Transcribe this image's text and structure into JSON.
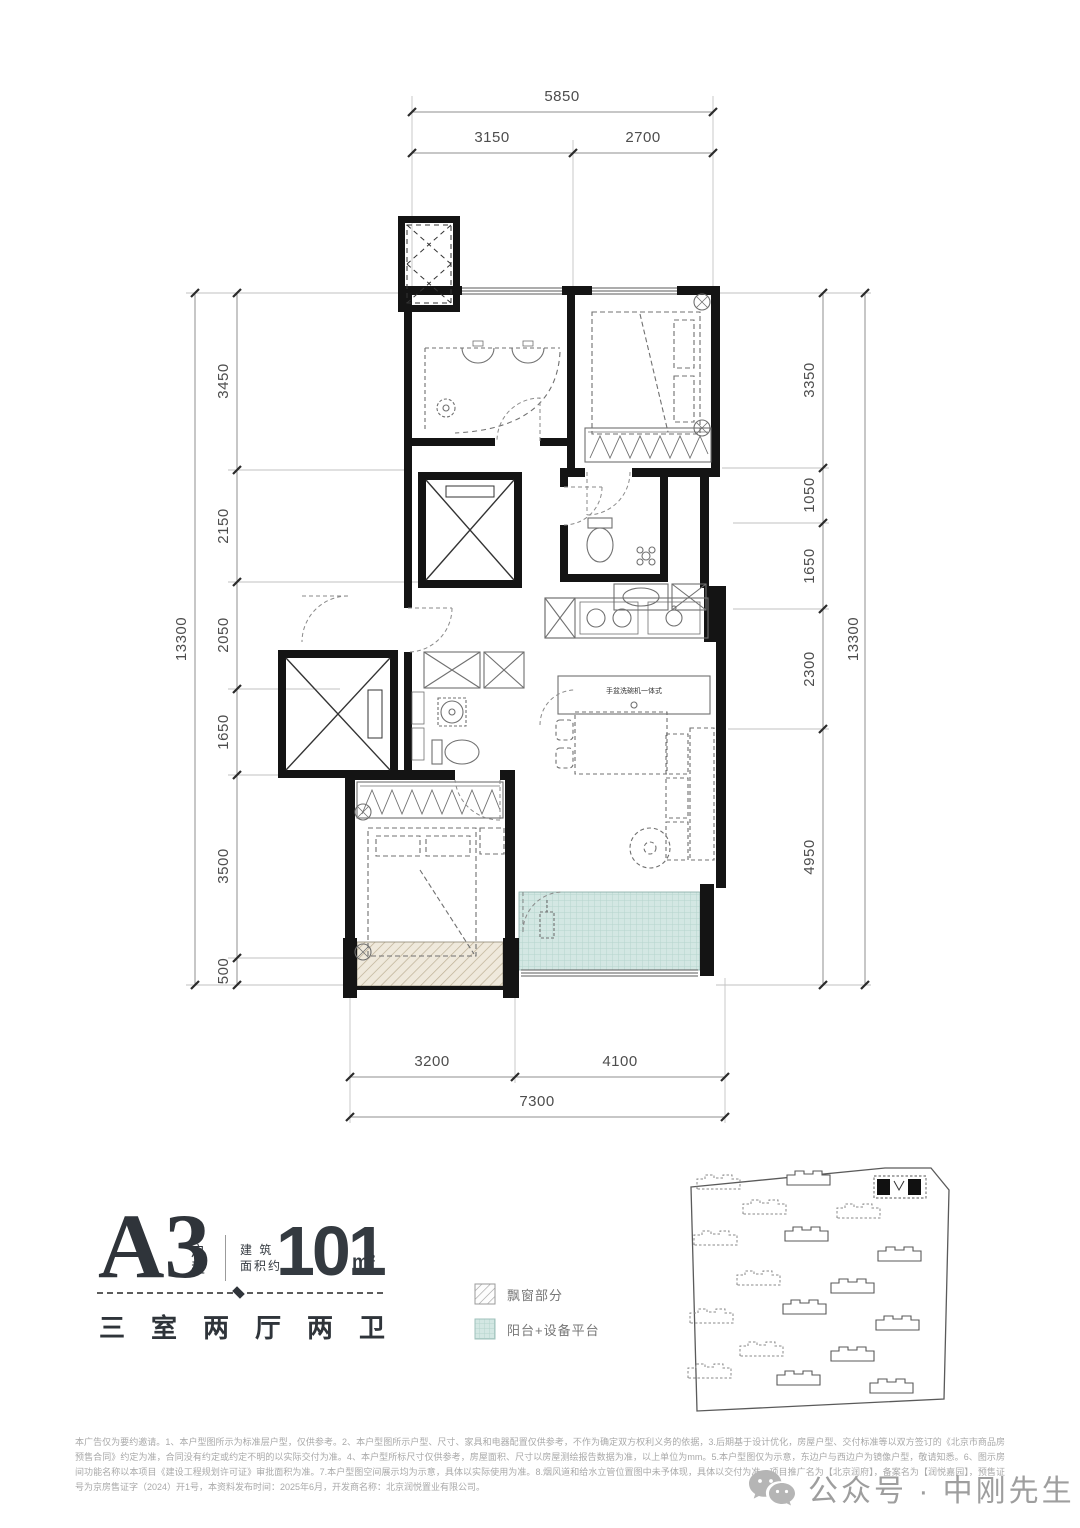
{
  "title_block": {
    "unit_code": "A3",
    "unit_code_suffix": "户型",
    "area_label_line1": "建 筑",
    "area_label_line2": "面积约",
    "area_value": "101",
    "area_unit": "m²",
    "rooms_summary": "三室两厅两卫"
  },
  "legend": {
    "bay_window": "飘窗部分",
    "balcony": "阳台+设备平台"
  },
  "dimensions": {
    "top": {
      "total": "5850",
      "segments": [
        "3150",
        "2700"
      ]
    },
    "bottom": {
      "total": "7300",
      "segments": [
        "3200",
        "4100"
      ]
    },
    "left": {
      "total": "13300",
      "segments": [
        "3450",
        "2150",
        "2050",
        "1650",
        "3500",
        "500"
      ]
    },
    "right": {
      "total": "13300",
      "segments": [
        "3350",
        "1050",
        "1650",
        "2300",
        "4950"
      ]
    }
  },
  "plan_labels": {
    "kitchen_island": "手盆洗碗机一体式"
  },
  "disclaimer": "本广告仅为要约邀请。1、本户型图所示为标准层户型，仅供参考。2、本户型图所示户型、尺寸、家具和电器配置仅供参考，不作为确定双方权利义务的依据，3.后期基于设计优化，房屋户型、交付标准等以双方签订的《北京市商品房预售合同》约定为准，合同没有约定或约定不明的以实际交付为准。4、本户型所标尺寸仅供参考，房屋面积、尺寸以房屋测绘报告数据为准，以上单位为mm。5.本户型图仅为示意，东边户与西边户为镜像户型，敬请知悉。6、图示房间功能名称以本项目《建设工程规划许可证》审批面积为准。7.本户型图空间展示均为示意，具体以实际使用为准。8.烟风道和给水立管位置图中未予体现，具体以交付为准。项目推广名为【北京润府】，备案名为【润悦嘉园】，预售证号为京房售证字（2024）开1号，本资料发布时间：2025年6月，开发商名称：北京润悦置业有限公司。",
  "watermark": {
    "text": "公众号 · 中刚先生"
  },
  "colors": {
    "balcony_fill": "#d3e7e3",
    "wall": "#141414"
  }
}
